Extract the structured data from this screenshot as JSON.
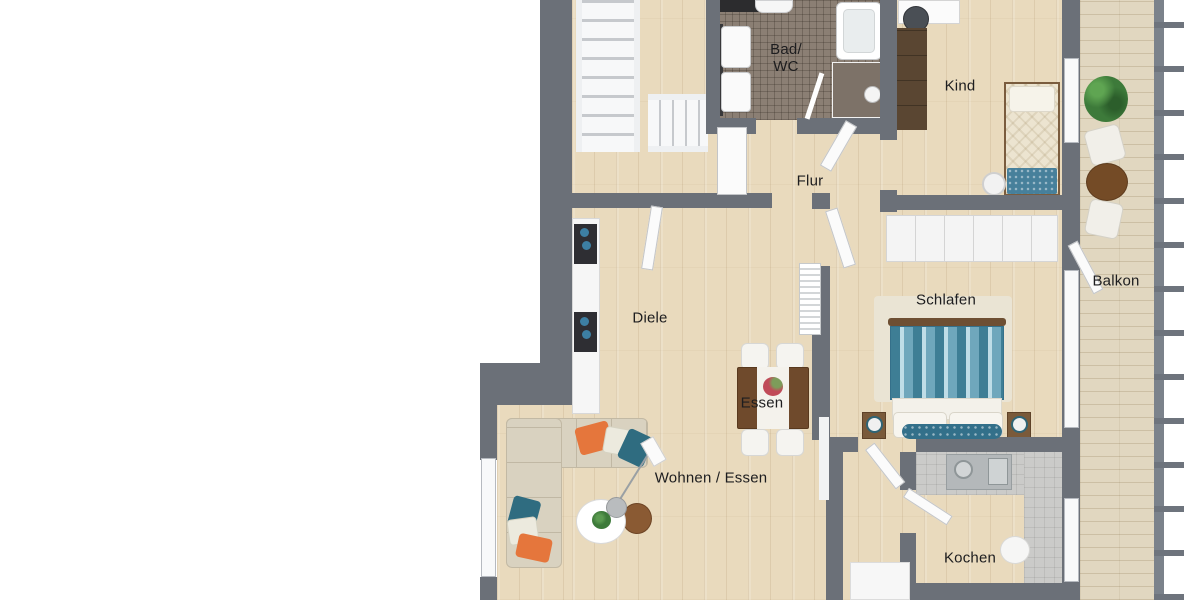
{
  "scene": {
    "type": "3d-floorplan-top-view",
    "description": "Apartment floor plan rendering with stairwell, bath, hall, child room, bedroom, living/dining room, kitchen and balcony"
  },
  "rooms": {
    "bad_wc": {
      "label_line1": "Bad/",
      "label_line2": "WC"
    },
    "flur": {
      "label": "Flur"
    },
    "kind": {
      "label": "Kind"
    },
    "diele": {
      "label": "Diele"
    },
    "schlafen": {
      "label": "Schlafen"
    },
    "balkon": {
      "label": "Balkon"
    },
    "essen": {
      "label": "Essen"
    },
    "wohnen_essen": {
      "label": "Wohnen / Essen"
    },
    "kochen": {
      "label": "Kochen"
    }
  },
  "furniture": {
    "stairwell": [
      "staircase",
      "lower-stair-flight"
    ],
    "bad_wc": [
      "bathtub",
      "shower",
      "washbasin",
      "washbasin"
    ],
    "kind": [
      "desk",
      "desk-chair",
      "wardrobe",
      "single-bed",
      "ball-lamp"
    ],
    "diele": [
      "sideboard",
      "radiator"
    ],
    "schlafen": [
      "wardrobe",
      "rug",
      "double-bed",
      "nightstand",
      "nightstand"
    ],
    "wohnen_essen": [
      "corner-sofa",
      "coffee-table",
      "side-table",
      "arc-floor-lamp",
      "dining-table",
      "chairs"
    ],
    "kochen": [
      "kitchen-counter",
      "sink",
      "round-table",
      "cabinet"
    ],
    "balkon": [
      "plant",
      "bistro-table",
      "chair",
      "chair",
      "railing"
    ]
  },
  "colors": {
    "wall": "#6b7078",
    "wood_floor": "#e9dabd",
    "bath_tile": "#8b7f74",
    "kitchen_tile": "#cbcbc9",
    "balcony_deck": "#e1d7c0",
    "sofa_beige": "#d9d2c0",
    "accent_orange": "#e5763c",
    "accent_teal": "#2f6c80",
    "bed_teal": "#3e7e95",
    "table_brown": "#6f4a2c",
    "wardrobe_brown": "#5a4632",
    "plant_green": "#3d7a3a"
  }
}
